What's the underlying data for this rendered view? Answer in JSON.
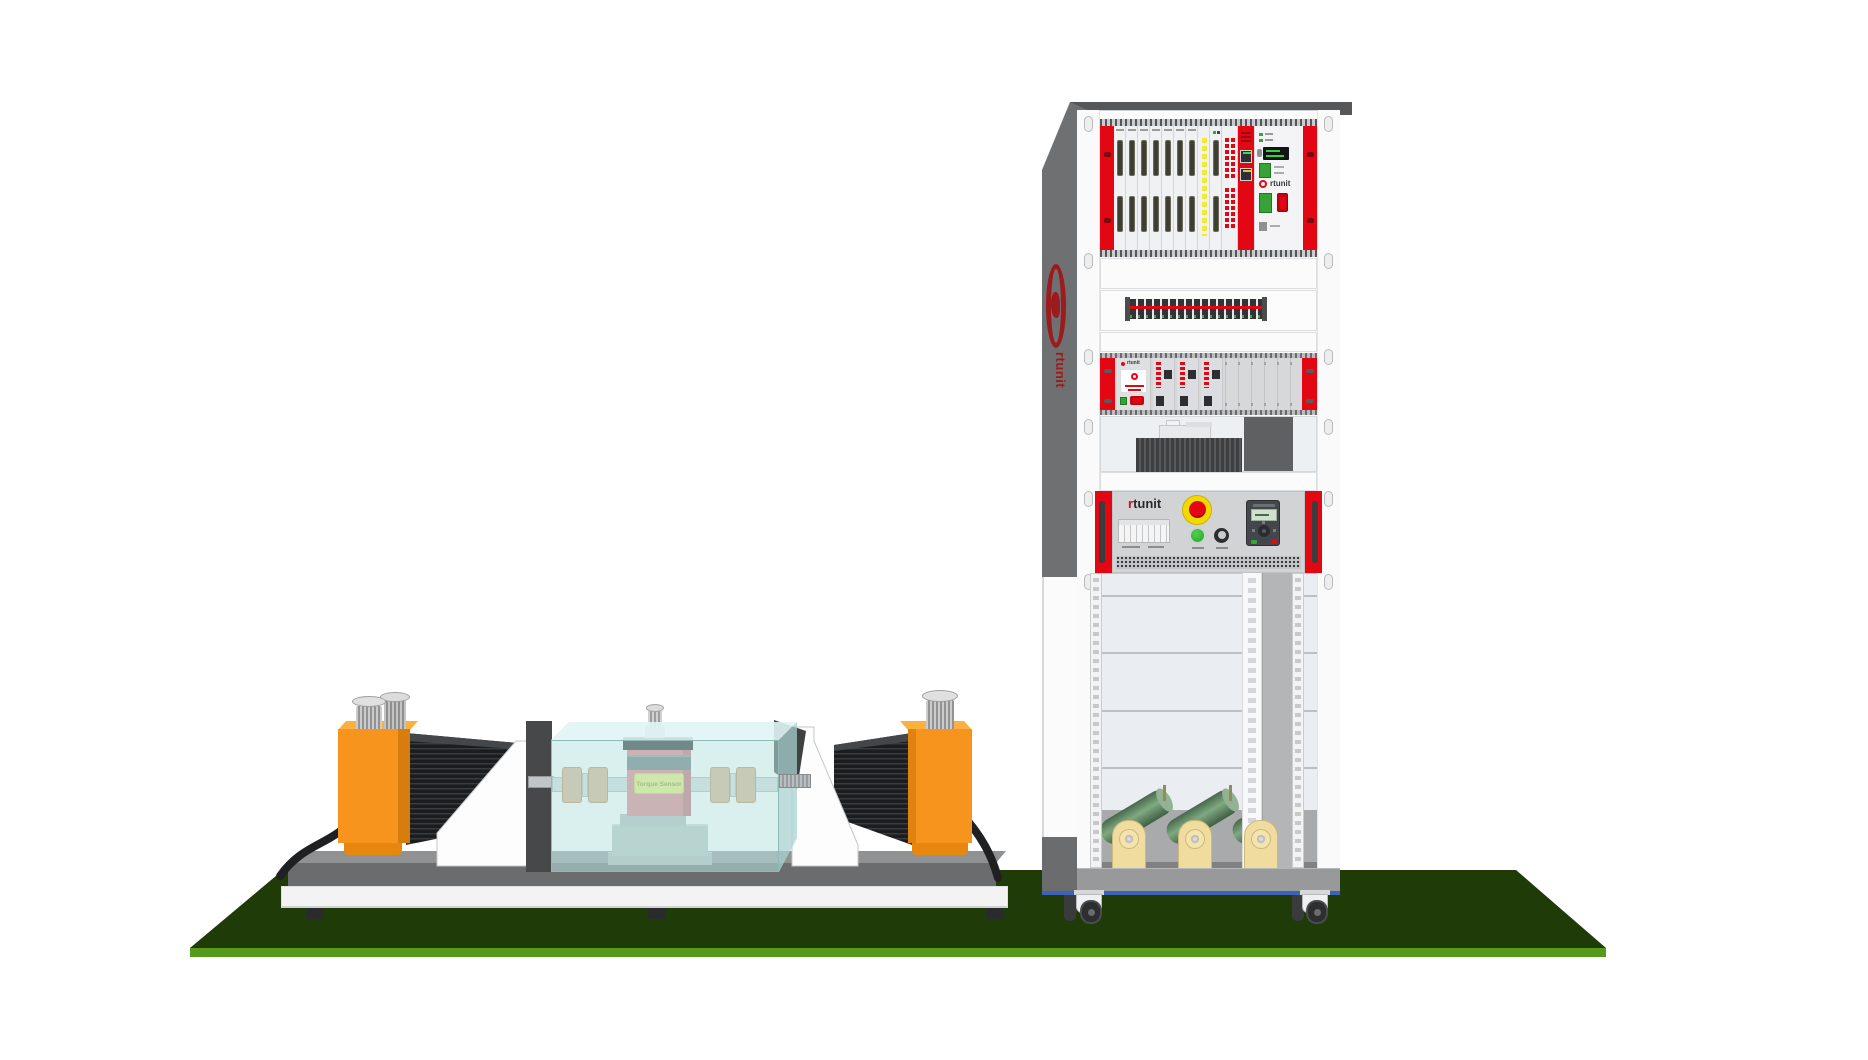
{
  "bench": {
    "torque_sensor_label": "Torque Sensor",
    "motor_count": 2,
    "coupling_count": 2
  },
  "rack": {
    "side_logo_text": "rtunit",
    "io_chassis_logo_text": "rtunit",
    "amplifier_logo_text": "rtunit",
    "control_panel_logo_r": "r",
    "control_panel_logo_rest": "tunit",
    "io_card_count": 7,
    "amplifier_card_count": 3,
    "load_resistor_count": 3,
    "caster_count": 4
  },
  "colors": {
    "accent_red": "#e30613",
    "motor_orange": "#f7941e",
    "mat_green_dark": "#1f3b07",
    "mat_green_edge": "#55991d",
    "rack_gray": "#6e7072",
    "resistor_green": "#5d8a62",
    "sensor_pink": "#df797e",
    "label_yellow": "#e7ee6b",
    "enclosure_teal": "#bae4e2",
    "estop_yellow": "#f3d900",
    "base_trim_blue": "#3d63b8",
    "stand_cream": "#efdc9e",
    "logo_dark_red": "#9c1b1f"
  }
}
